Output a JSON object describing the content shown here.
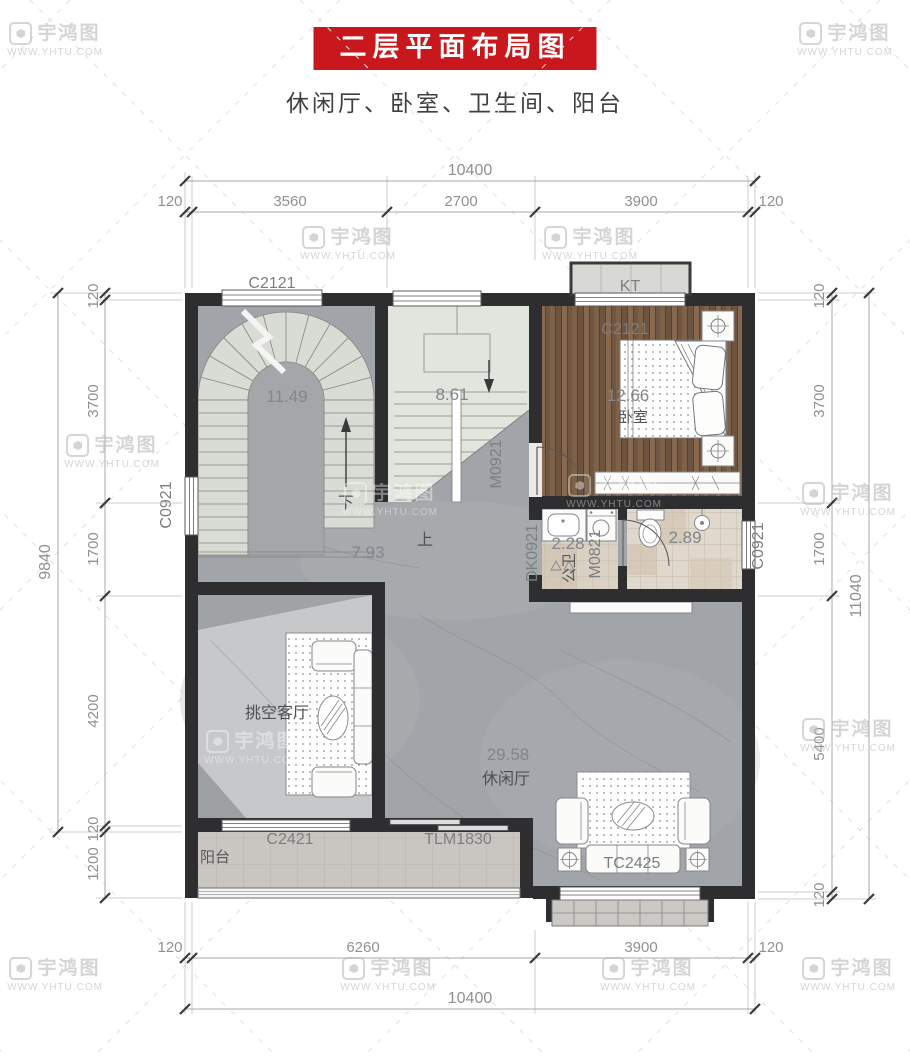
{
  "header": {
    "title": "二层平面布局图",
    "subtitle": "休闲厅、卧室、卫生间、阳台"
  },
  "watermark": {
    "brand": "宇鸿图",
    "url": "WWW.YHTU.COM"
  },
  "dims": {
    "top": {
      "total": "10400",
      "segments": [
        "120",
        "3560",
        "2700",
        "3900",
        "120"
      ]
    },
    "bottom": {
      "total": "10400",
      "segments": [
        "120",
        "6260",
        "3900",
        "120"
      ]
    },
    "left": {
      "total": "9840",
      "segments": [
        "120",
        "3700",
        "1700",
        "4200",
        "120",
        "1200"
      ]
    },
    "right": {
      "total": "11040",
      "segments": [
        "120",
        "3700",
        "1700",
        "5400",
        "120"
      ]
    }
  },
  "rooms": {
    "stair": {
      "area": "11.49",
      "down": "下"
    },
    "stair2": {
      "area": "8.61"
    },
    "bedroom": {
      "area": "12.66",
      "name": "卧室"
    },
    "hall": {
      "area": "7.93",
      "up": "上"
    },
    "bath1": {
      "area": "2.28",
      "name": "公卫"
    },
    "bath2": {
      "area": "2.89"
    },
    "living": {
      "name": "挑空客厅"
    },
    "leisure": {
      "area": "29.58",
      "name": "休闲厅"
    },
    "balcony": {
      "name": "阳台"
    }
  },
  "openings": {
    "win_top_left": "C2121",
    "kt": "KT",
    "win_bedroom": "C2121",
    "door_bedroom": "M0921",
    "win_left": "C0921",
    "win_right": "C0921",
    "open_bath": "DK0921",
    "door_bath": "M0821",
    "win_living": "C2421",
    "door_balcony": "TLM1830",
    "win_leisure": "TC2425"
  },
  "colors": {
    "title_bg": "#c9181d",
    "wall": "#2e2e30",
    "wood": "#755842",
    "marble": "#a1a4a8",
    "living_light": "#c6c8ca",
    "bath_tile": "#ddd5c8"
  }
}
